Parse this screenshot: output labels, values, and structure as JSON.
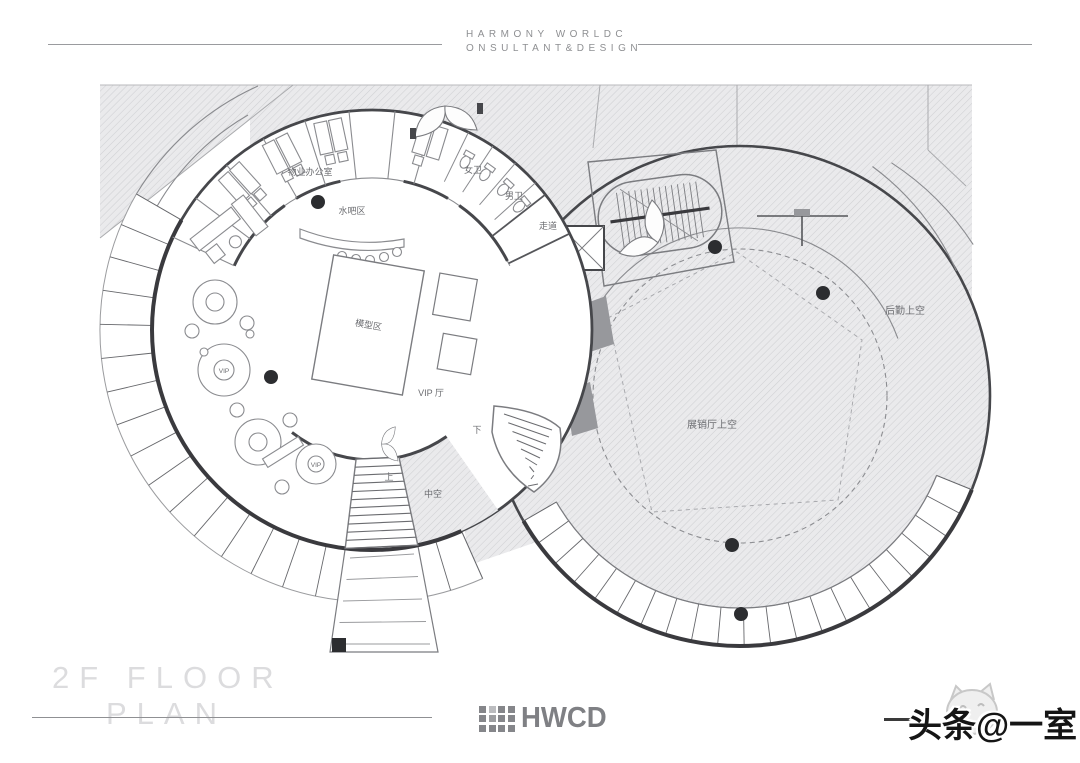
{
  "header": {
    "line1": "HARMONY WORLDC",
    "line2": "ONSULTANT&DESIGN"
  },
  "plan": {
    "labels": {
      "property_office": "物业办公室",
      "water_bar": "水吧区",
      "women_wc": "女卫",
      "men_wc": "男卫",
      "corridor": "走道",
      "model_area": "模型区",
      "vip_hall": "VIP 厅",
      "down": "下",
      "up": "上",
      "atrium": "中空",
      "logistics_void": "后勤上空",
      "exhibition_void": "展销厅上空",
      "vip_booth_a": "VIP",
      "vip_booth_b": "VIP"
    }
  },
  "footer": {
    "title_line1": "2F FLOOR",
    "title_line2": "PLAN",
    "logo": "HWCD",
    "watermark": "头条@一室"
  },
  "colors": {
    "wall": "#46474b",
    "hatch_line": "#cfd0d3",
    "hatch_bg": "#eaeaec",
    "label_gray": "#6b6c70",
    "title_gray": "#dcdcde",
    "logo_gray": "#7f8084",
    "watermark_black": "#151515"
  }
}
